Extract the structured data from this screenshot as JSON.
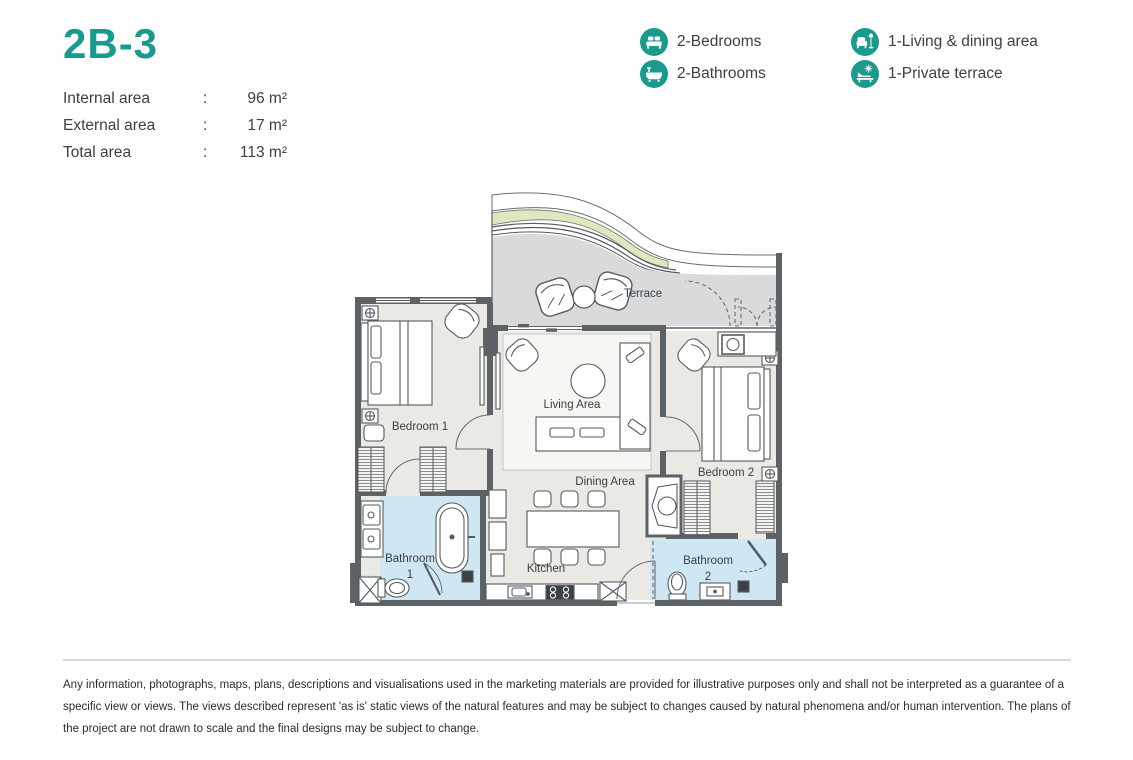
{
  "unit": {
    "title": "2B-3"
  },
  "areas": {
    "separator": ":",
    "rows": [
      {
        "label": "Internal area",
        "value": "96 m²"
      },
      {
        "label": "External area",
        "value": "17 m²"
      },
      {
        "label": "Total area",
        "value": "113 m²"
      }
    ]
  },
  "legend": {
    "items": [
      {
        "icon": "bed-icon",
        "label": "2-Bedrooms"
      },
      {
        "icon": "bathtub-icon",
        "label": "2-Bathrooms"
      },
      {
        "icon": "sofa-lamp-icon",
        "label": "1-Living & dining area"
      },
      {
        "icon": "terrace-icon",
        "label": "1-Private terrace"
      }
    ]
  },
  "floorplan": {
    "labels": {
      "terrace": "Terrace",
      "living": "Living Area",
      "dining": "Dining Area",
      "kitchen": "Kitchen",
      "bedroom1": "Bedroom 1",
      "bedroom2": "Bedroom 2",
      "bathroom1_line1": "Bathroom",
      "bathroom1_line2": "1",
      "bathroom2_line1": "Bathroom",
      "bathroom2_line2": "2"
    }
  },
  "colors": {
    "accent": "#199a8c",
    "wall": "#5d6266",
    "interior_floor": "#ebe9e4",
    "terrace_floor": "#d8dadc",
    "bathroom_floor": "#cfe6f3",
    "planter_green": "#dbe8c0"
  },
  "disclaimer": {
    "lines": [
      "Any information, photographs, maps, plans, descriptions and visualisations used in the marketing materials are provided for illustrative purposes only and shall not be interpreted as a guarantee of a",
      "specific view or views. The views described represent 'as is' static views of the natural features and may be subject to changes caused by natural phenomena and/or human intervention. The plans of",
      "the project are not drawn to scale and the final designs may be subject to change."
    ]
  }
}
